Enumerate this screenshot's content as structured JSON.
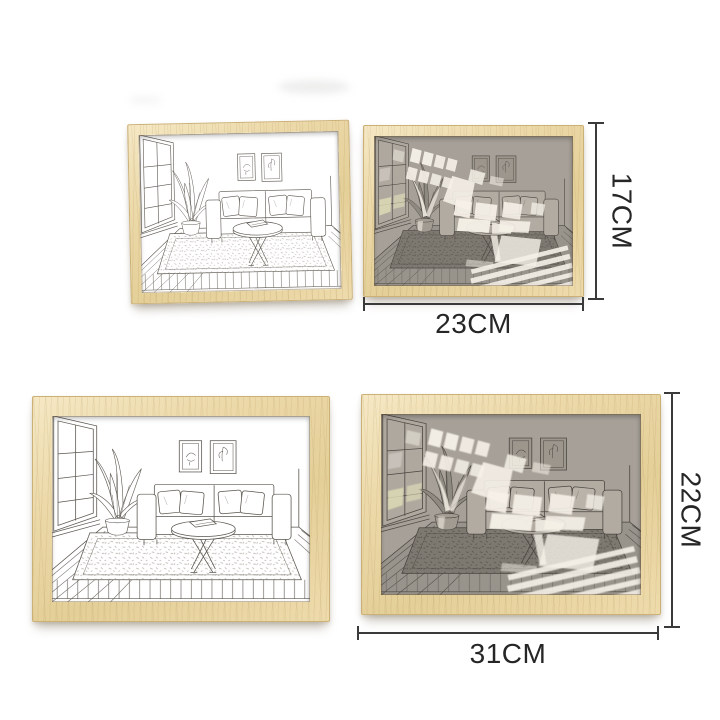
{
  "annotations": {
    "small_pair": {
      "height": "17CM",
      "width": "23CM"
    },
    "large_pair": {
      "height": "22CM",
      "width": "31CM"
    }
  },
  "colors": {
    "wood_frame": "#ecd9a9",
    "dimension_lines": "#3a3a3a",
    "label_text": "#262626",
    "sketch_ink": "#5a554e",
    "backlit_wall": "#a6a098",
    "light_beam": "#f6f1e8"
  }
}
